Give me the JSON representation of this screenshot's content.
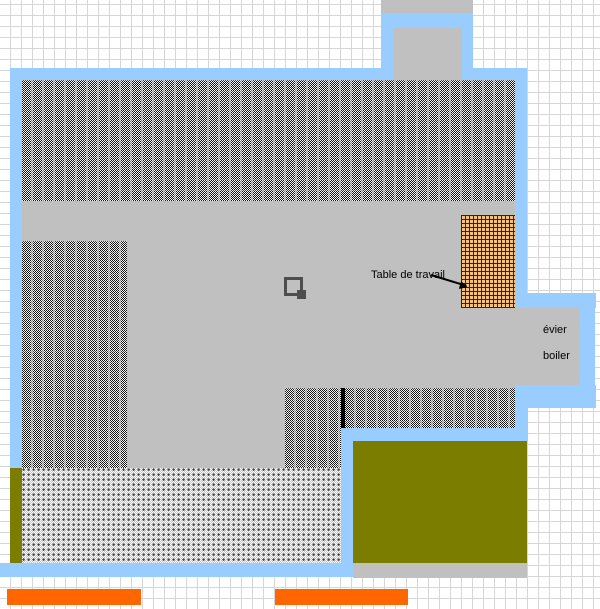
{
  "labels": {
    "work_table": "Table de travail",
    "sink": "évier",
    "boiler": "boiler"
  },
  "colors": {
    "wall": "#99CCFF",
    "floor": "#C0C0C0",
    "grid_line": "#D6D6D6",
    "garden": "#7B7D00",
    "orange_bar": "#FF6600",
    "table_fill": "#F2C27E",
    "table_line": "#3A2500",
    "hatch_dark": "#111111",
    "pillar": "#4D4D4D",
    "annotation": "#000000"
  }
}
